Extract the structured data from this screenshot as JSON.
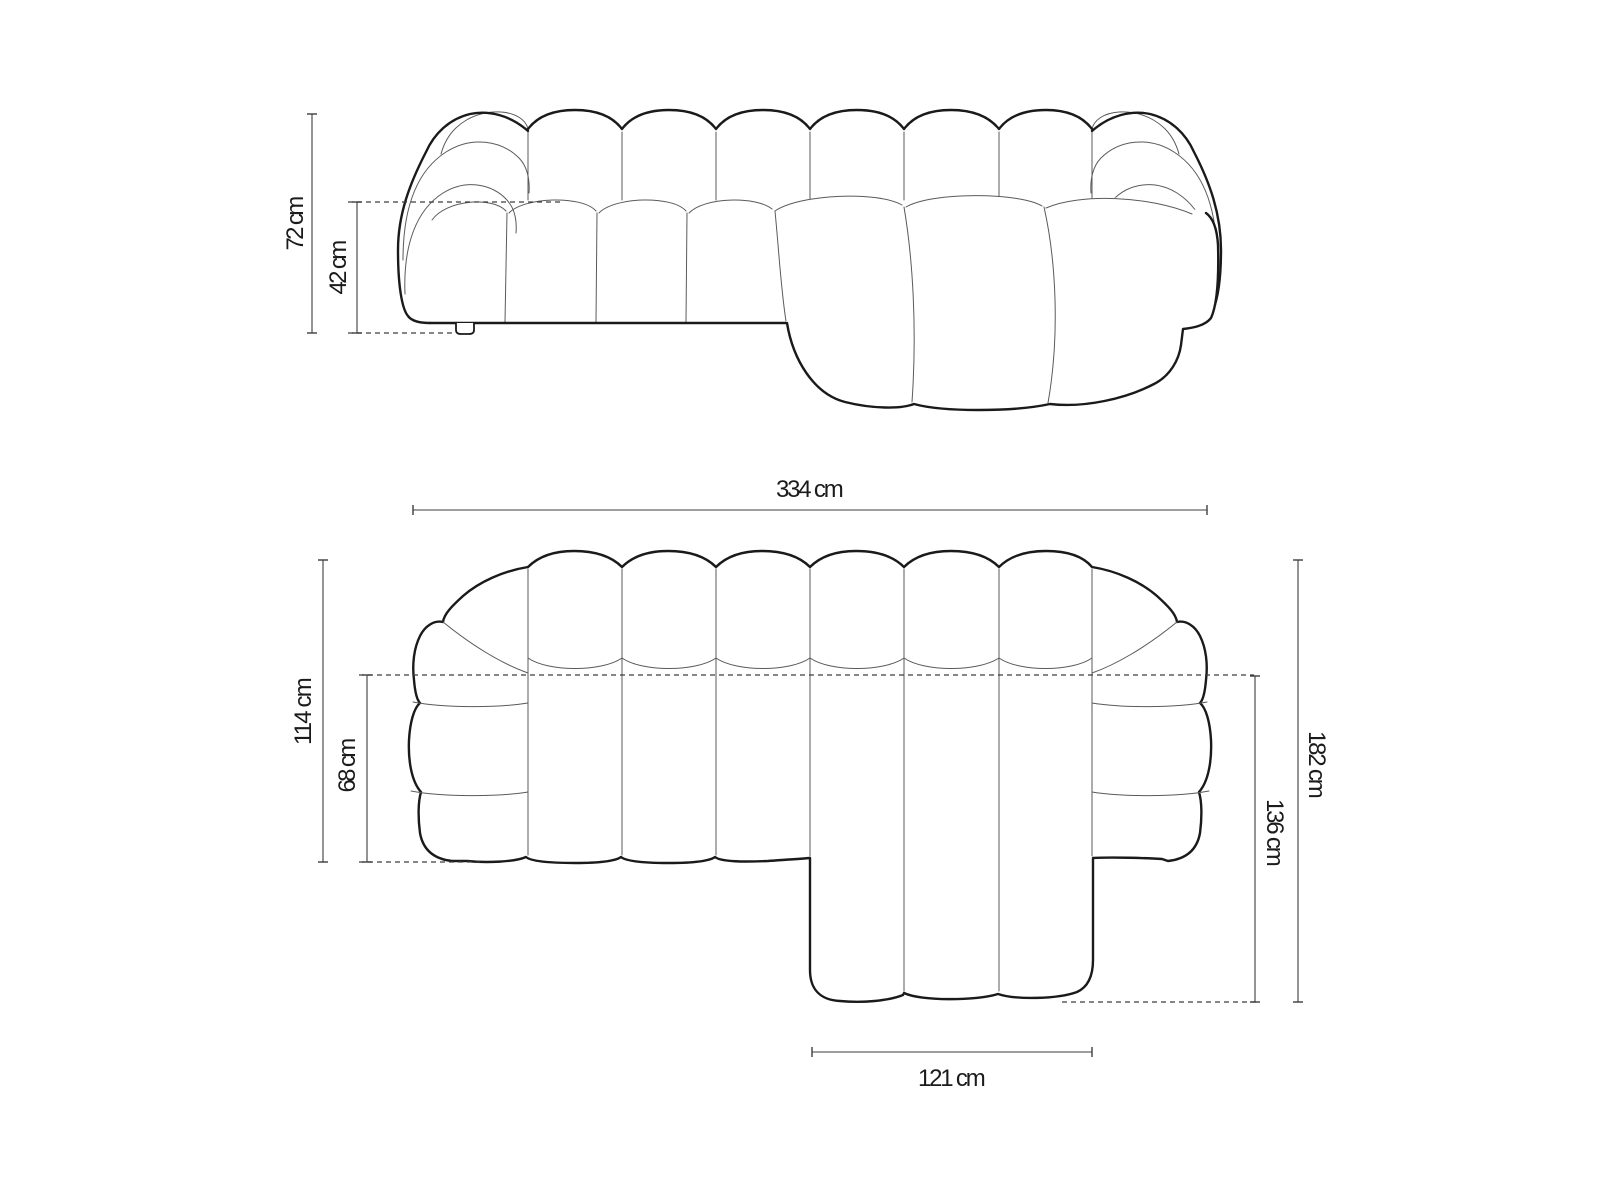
{
  "diagram": {
    "type": "sofa-dimension-drawing",
    "front_view": {
      "labels": {
        "total_height": "72 cm",
        "seat_height": "42 cm"
      }
    },
    "top_view": {
      "labels": {
        "total_width": "334 cm",
        "body_depth": "114 cm",
        "seat_depth": "68 cm",
        "total_depth": "182 cm",
        "chaise_depth": "136 cm",
        "chaise_width": "121 cm"
      }
    },
    "colors": {
      "background": "#ffffff",
      "outline": "#1a1a1a",
      "seam": "#5a5a5a",
      "dimension": "#3d3d3d",
      "text": "#1b1b1b"
    }
  }
}
